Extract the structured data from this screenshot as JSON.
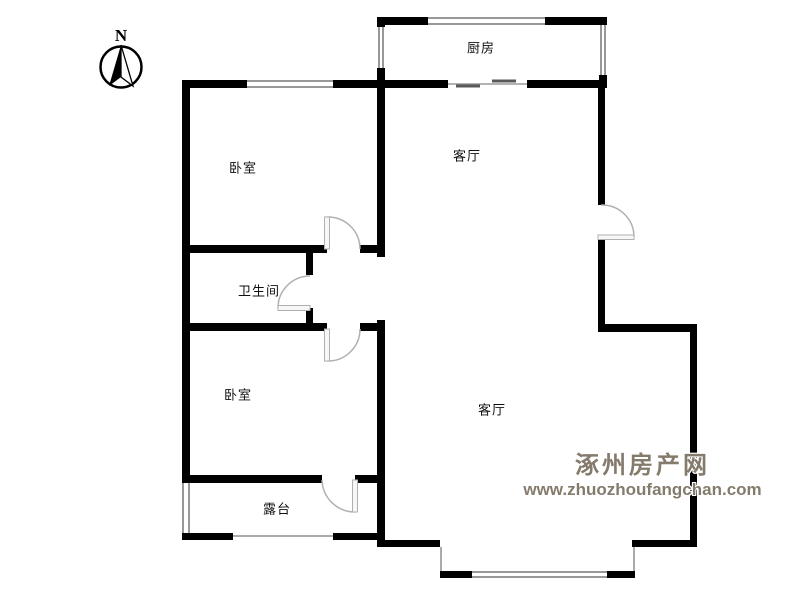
{
  "compass": {
    "label": "N"
  },
  "rooms": [
    {
      "id": "kitchen",
      "label": "厨房"
    },
    {
      "id": "living-upper",
      "label": "客厅"
    },
    {
      "id": "bedroom-upper",
      "label": "卧室"
    },
    {
      "id": "bathroom",
      "label": "卫生间"
    },
    {
      "id": "bedroom-lower",
      "label": "卧室"
    },
    {
      "id": "living-lower",
      "label": "客厅"
    },
    {
      "id": "terrace",
      "label": "露台"
    }
  ],
  "watermark": {
    "site_name": "涿州房产网",
    "site_url": "www.zhuozhoufangchan.com",
    "color": "#857b6d"
  },
  "colors": {
    "wall": "#000000",
    "window_line": "#989898",
    "door_arc": "#b0b0b0",
    "label_text": "#111111"
  }
}
